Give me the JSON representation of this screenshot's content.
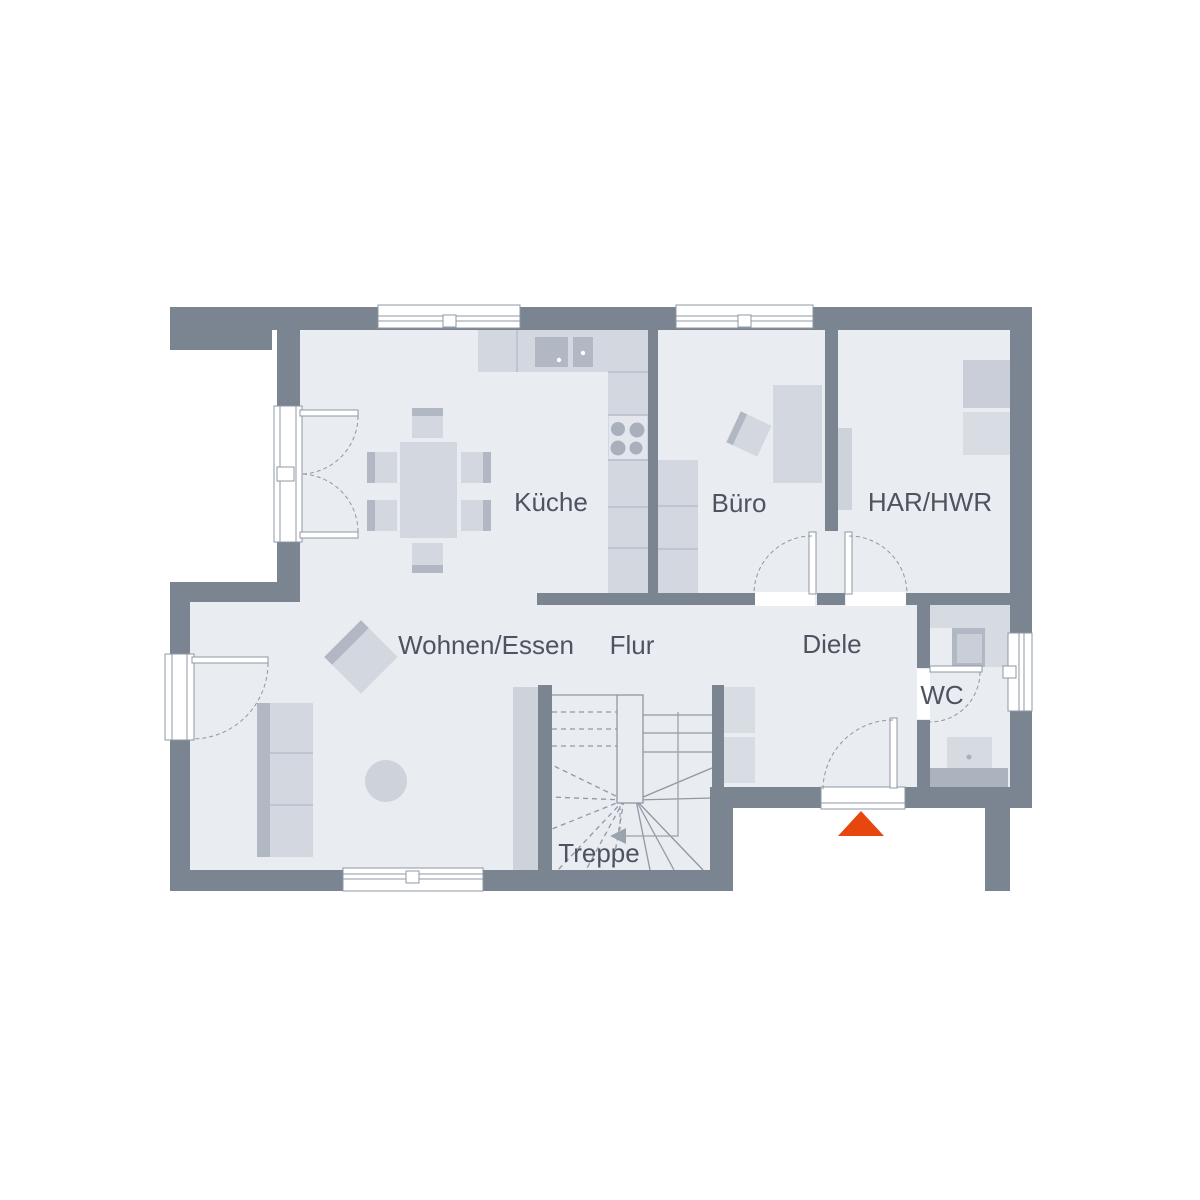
{
  "rooms": {
    "kueche": {
      "label": "Küche"
    },
    "buero": {
      "label": "Büro"
    },
    "har_hwr": {
      "label": "HAR/HWR"
    },
    "wohnen_essen": {
      "label": "Wohnen/Essen"
    },
    "flur": {
      "label": "Flur"
    },
    "diele": {
      "label": "Diele"
    },
    "wc": {
      "label": "WC"
    },
    "treppe": {
      "label": "Treppe"
    }
  },
  "colors": {
    "background": "#FFFFFF",
    "wall": "#7A8591",
    "floor": "#E9ECF1",
    "furniture_light": "#D3D8E0",
    "furniture_lighter": "#D8DCE3",
    "furniture_medium": "#C9CED8",
    "furniture_dark": "#B2B8C3",
    "outline": "#8F98A4",
    "label_text": "#4D5460",
    "entrance_marker": "#E8460F"
  },
  "icons": {
    "entrance_marker": "triangle-up",
    "stair_direction_arrow": "arrow-left"
  }
}
